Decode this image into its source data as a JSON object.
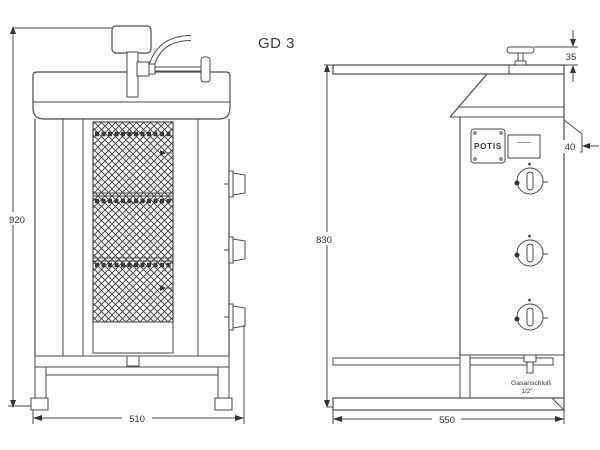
{
  "title": "GD 3",
  "front_view": {
    "height_label": "920",
    "width_label": "510"
  },
  "side_view": {
    "height_label": "830",
    "width_label": "550",
    "handle_offset_label": "35",
    "bracket_depth_label": "40",
    "brand_plate_label": "POTIS",
    "type_plate_label": "———",
    "gas_connection_label": "Gasanschluß",
    "gas_size_label": "1/2\""
  },
  "colors": {
    "line": "#4a4a4a",
    "text": "#333333",
    "background": "#ffffff"
  }
}
